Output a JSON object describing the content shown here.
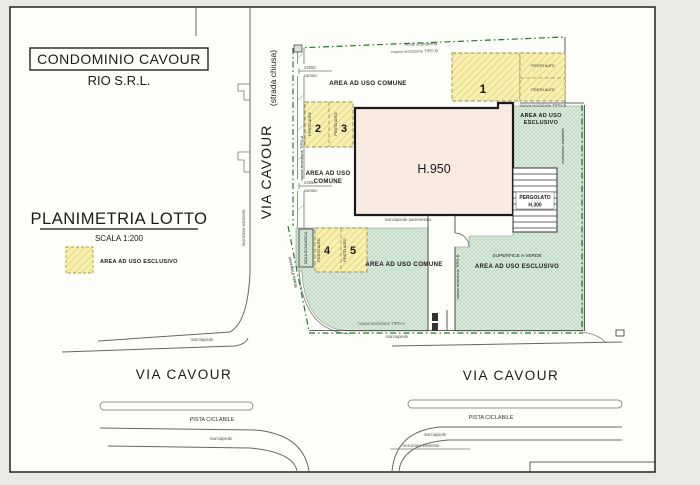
{
  "colors": {
    "fence_green": "#1e7d1e",
    "label_red": "#c04040",
    "stall_number_red": "#9c3b2a",
    "area_number_olive": "#8a6a28",
    "pergola_red": "#8b2020",
    "yellow_area": "#f8f1ae",
    "green_area": "#dcebdd",
    "building_fill": "#f9ebe2"
  },
  "title_block": {
    "project": "CONDOMINIO  CAVOUR",
    "company": "RIO S.R.L."
  },
  "legend": {
    "title": "PLANIMETRIA LOTTO",
    "scale": "SCALA 1:200",
    "swatch_label": "AREA AD USO ESCLUSIVO"
  },
  "street_vertical": {
    "name": "VIA CAVOUR",
    "status": "(strada chiusa)",
    "fence": "recinzione esistente"
  },
  "boundaries": {
    "limite": "limite di proprieta'",
    "tipo_b_top": "nuova recinzione TIPO-B",
    "tipo_b_boxes": "nuova recinzione TIPO-B",
    "tipo_b_corridor": "nuova recinzione TIPO-B",
    "tipo_a_left": "nuova recinzione TIPO-A",
    "tipo_a_bottom": "nuova recinzione TIPO-A",
    "recinzione_esistente_right": "recinzione esistente",
    "recinzione_esistente_bottom": "recinzione esistente",
    "strada_ingresso": "strada d'ingresso"
  },
  "areas": {
    "comune_top": "AREA AD USO COMUNE",
    "comune_mid_1": "AREA AD USO",
    "comune_mid_2": "COMUNE",
    "comune_bottom": "AREA AD USO COMUNE",
    "esclusivo_right_1": "AREA AD USO",
    "esclusivo_right_2": "ESCLUSIVO",
    "superficie_verde": "SUPERFICE A VERDE",
    "esclusivo_bottom": "AREA AD USO ESCLUSIVO"
  },
  "building": {
    "label": "H.950",
    "sidewalk": "marciapiede pavimentato",
    "pergolato": "PERGOLATO",
    "pergolato_height": "H.300"
  },
  "parking": {
    "stall_label": "POSTO AUTO",
    "n1": "1",
    "n2": "2",
    "n3": "3",
    "n4": "4",
    "n5": "5",
    "isola": "ISOLA ECOLOGICA"
  },
  "gates": {
    "dim_1": "24650",
    "type_1": "carraio",
    "dim_2": "24650",
    "type_2": "carraio"
  },
  "roads": {
    "via_cavour_left": "VIA CAVOUR",
    "via_cavour_right": "VIA CAVOUR",
    "pista_left": "PISTA CICLABILE",
    "pista_right": "PISTA CICLABILE",
    "marciapiede_1": "marciapiede",
    "marciapiede_2": "marciapiede",
    "marciapiede_3": "marciapiede",
    "marciapiede_4": "marciapiede"
  }
}
